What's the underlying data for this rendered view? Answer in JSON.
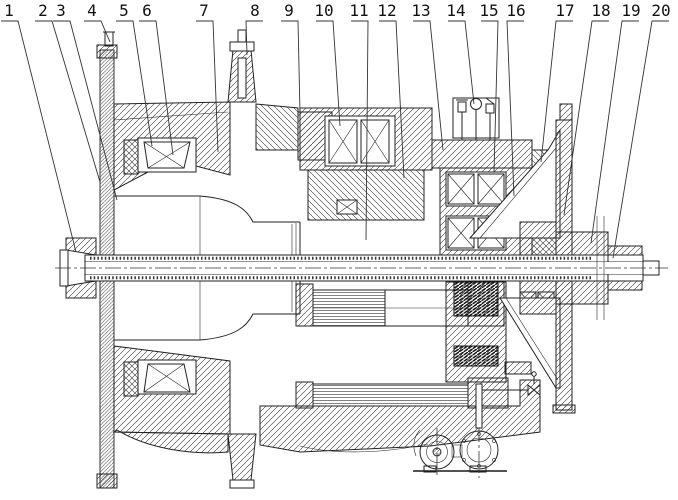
{
  "figure": {
    "background_color": "#ffffff",
    "line_color": "#222222",
    "callouts": [
      {
        "n": "1",
        "x": 9,
        "tx": 76,
        "ty": 252
      },
      {
        "n": "2",
        "x": 43,
        "tx": 100,
        "ty": 182
      },
      {
        "n": "3",
        "x": 61,
        "tx": 117,
        "ty": 200
      },
      {
        "n": "4",
        "x": 92,
        "tx": 110,
        "ty": 42
      },
      {
        "n": "5",
        "x": 124,
        "tx": 152,
        "ty": 146
      },
      {
        "n": "6",
        "x": 147,
        "tx": 173,
        "ty": 155
      },
      {
        "n": "7",
        "x": 204,
        "tx": 218,
        "ty": 152
      },
      {
        "n": "8",
        "x": 255,
        "tx": 247,
        "ty": 55
      },
      {
        "n": "9",
        "x": 289,
        "tx": 300,
        "ty": 114
      },
      {
        "n": "10",
        "x": 324,
        "tx": 340,
        "ty": 126
      },
      {
        "n": "11",
        "x": 359,
        "tx": 366,
        "ty": 240
      },
      {
        "n": "12",
        "x": 387,
        "tx": 404,
        "ty": 178
      },
      {
        "n": "13",
        "x": 421,
        "tx": 443,
        "ty": 150
      },
      {
        "n": "14",
        "x": 456,
        "tx": 474,
        "ty": 104
      },
      {
        "n": "15",
        "x": 489,
        "tx": 494,
        "ty": 172
      },
      {
        "n": "16",
        "x": 516,
        "tx": 514,
        "ty": 196
      },
      {
        "n": "17",
        "x": 565,
        "tx": 541,
        "ty": 162
      },
      {
        "n": "18",
        "x": 601,
        "tx": 564,
        "ty": 215
      },
      {
        "n": "19",
        "x": 631,
        "tx": 591,
        "ty": 243
      },
      {
        "n": "20",
        "x": 661,
        "tx": 613,
        "ty": 258
      }
    ]
  }
}
